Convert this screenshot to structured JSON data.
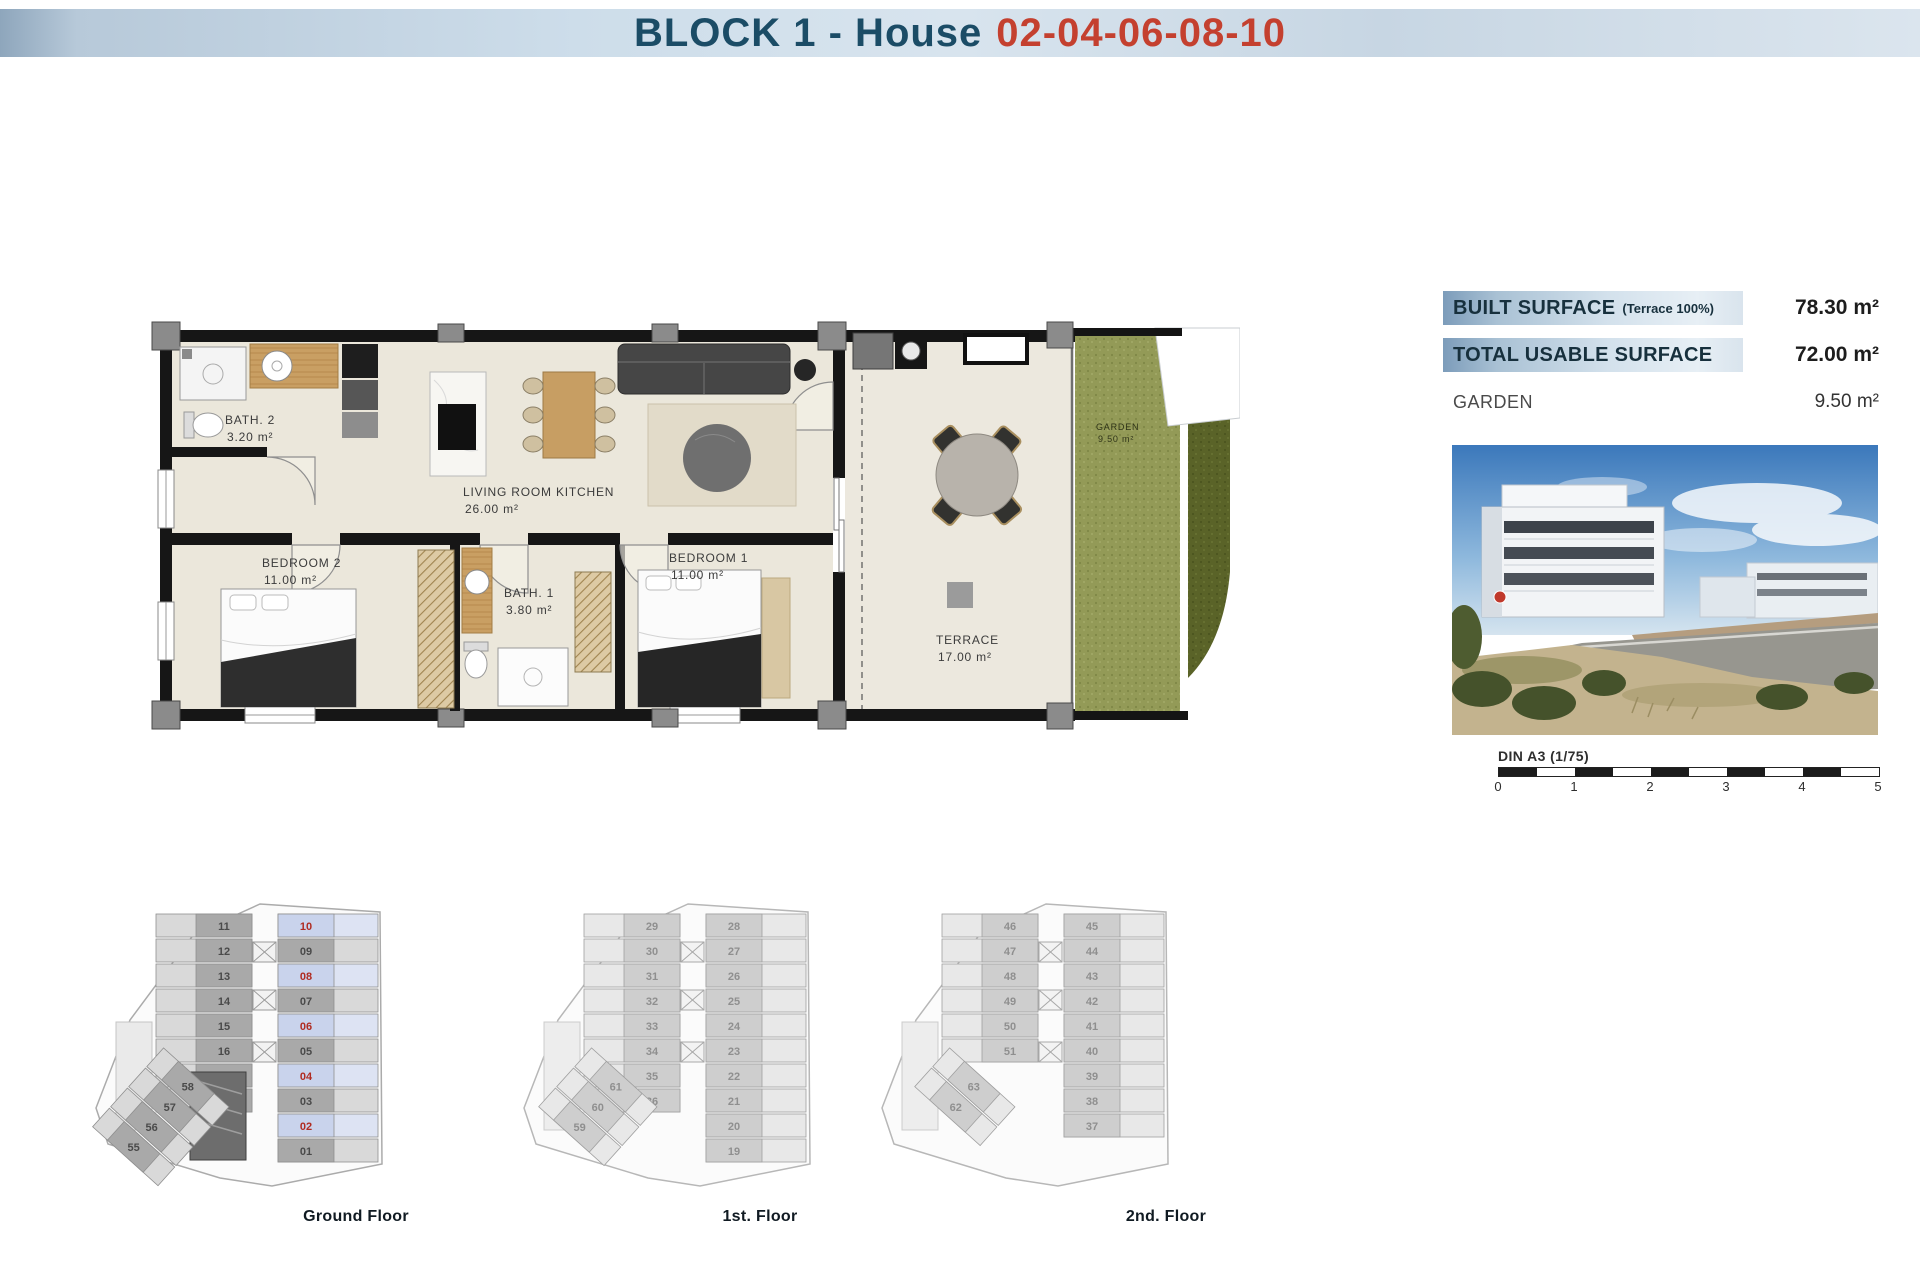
{
  "header": {
    "title_prefix": "BLOCK 1 - House",
    "title_numbers": "02-04-06-08-10"
  },
  "plan": {
    "rooms": {
      "bath2": {
        "name": "BATH. 2",
        "area": "3.20 m²"
      },
      "living": {
        "name": "LIVING ROOM KITCHEN",
        "area": "26.00 m²"
      },
      "bedroom2": {
        "name": "BEDROOM 2",
        "area": "11.00 m²"
      },
      "bath1": {
        "name": "BATH. 1",
        "area": "3.80 m²"
      },
      "bedroom1": {
        "name": "BEDROOM 1",
        "area": "11.00 m²"
      },
      "terrace": {
        "name": "TERRACE",
        "area": "17.00 m²"
      },
      "garden": {
        "name": "GARDEN",
        "area": "9.50 m²"
      }
    }
  },
  "surface_table": {
    "rows": [
      {
        "label": "BUILT SURFACE",
        "note": "(Terrace 100%)",
        "value": "78.30 m²",
        "highlight": true
      },
      {
        "label": "TOTAL USABLE SURFACE",
        "note": "",
        "value": "72.00 m²",
        "highlight": true
      },
      {
        "label": "GARDEN",
        "note": "",
        "value": "9.50 m²",
        "highlight": false
      }
    ]
  },
  "scale_bar": {
    "label": "DIN A3 (1/75)",
    "ticks": [
      "0",
      "1",
      "2",
      "3",
      "4",
      "5"
    ]
  },
  "floors": [
    {
      "label": "Ground Floor",
      "left_units": [
        "11",
        "12",
        "13",
        "14",
        "15",
        "16",
        "17",
        "18"
      ],
      "right_units": [
        "10",
        "09",
        "08",
        "07",
        "06",
        "05",
        "04",
        "03",
        "02",
        "01"
      ],
      "wing_units": [
        "58",
        "57",
        "56",
        "55"
      ],
      "highlighted": [
        "10",
        "08",
        "06",
        "04",
        "02"
      ],
      "faded": false
    },
    {
      "label": "1st. Floor",
      "left_units": [
        "29",
        "30",
        "31",
        "32",
        "33",
        "34",
        "35",
        "36"
      ],
      "right_units": [
        "28",
        "27",
        "26",
        "25",
        "24",
        "23",
        "22",
        "21",
        "20",
        "19"
      ],
      "wing_units": [
        "61",
        "60",
        "59"
      ],
      "highlighted": [],
      "faded": true
    },
    {
      "label": "2nd. Floor",
      "left_units": [
        "46",
        "47",
        "48",
        "49",
        "50",
        "51"
      ],
      "right_units": [
        "45",
        "44",
        "43",
        "42",
        "41",
        "40",
        "39",
        "38",
        "37"
      ],
      "wing_units": [
        "63",
        "62"
      ],
      "highlighted": [],
      "faded": true
    }
  ],
  "colors": {
    "title_blue": "#1b4c66",
    "title_red": "#c4402f",
    "highlight_number": "#b02c22",
    "highlight_cell": "#c9d3ec",
    "grass": "#939a57",
    "hedge": "#5a6328"
  }
}
